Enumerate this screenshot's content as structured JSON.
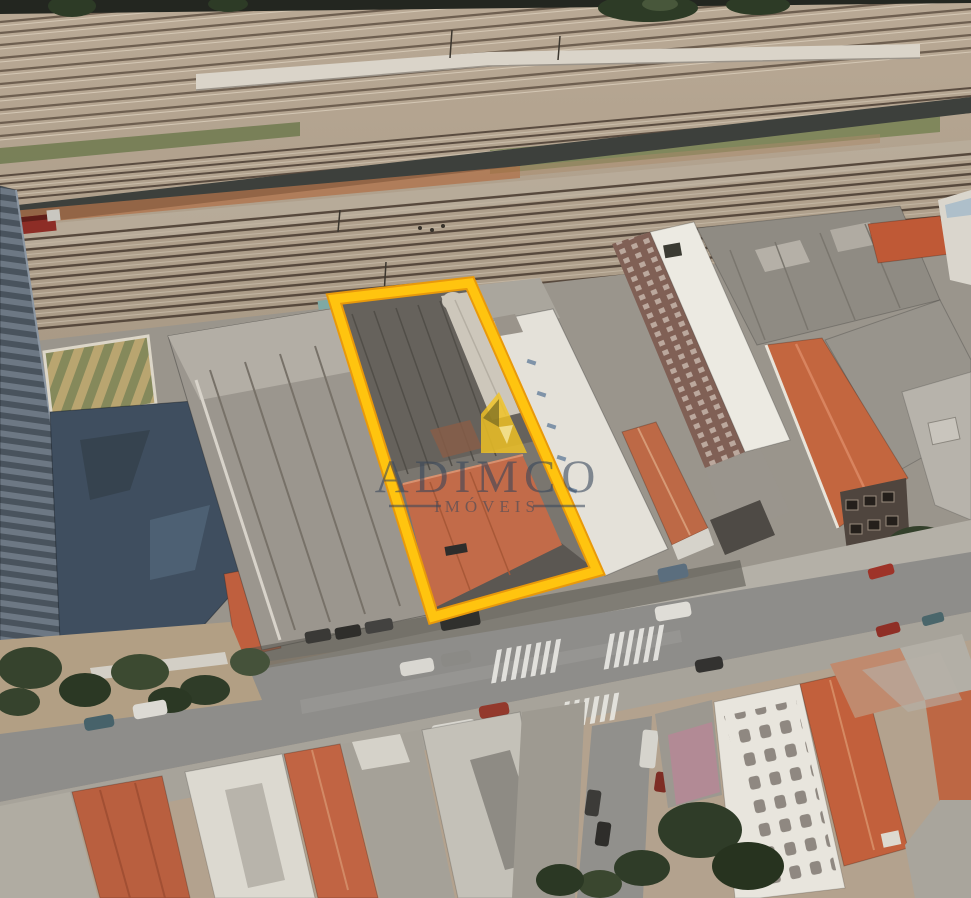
{
  "watermark": {
    "brand": "ADIMCO",
    "tagline": "IMÓVEIS",
    "text_color": "#36455A",
    "logo_color": "#F2C322"
  },
  "highlight": {
    "color": "#FFC40F",
    "label": "highlighted-property-lot"
  },
  "palette": {
    "terracotta_roof": "#C2663F",
    "warehouse_gray": "#9B968E",
    "street_asphalt": "#8E8D8A",
    "railway_ground": "#B3A28E",
    "tree_green": "#36432D",
    "podium_blue": "#3F4E5F"
  }
}
